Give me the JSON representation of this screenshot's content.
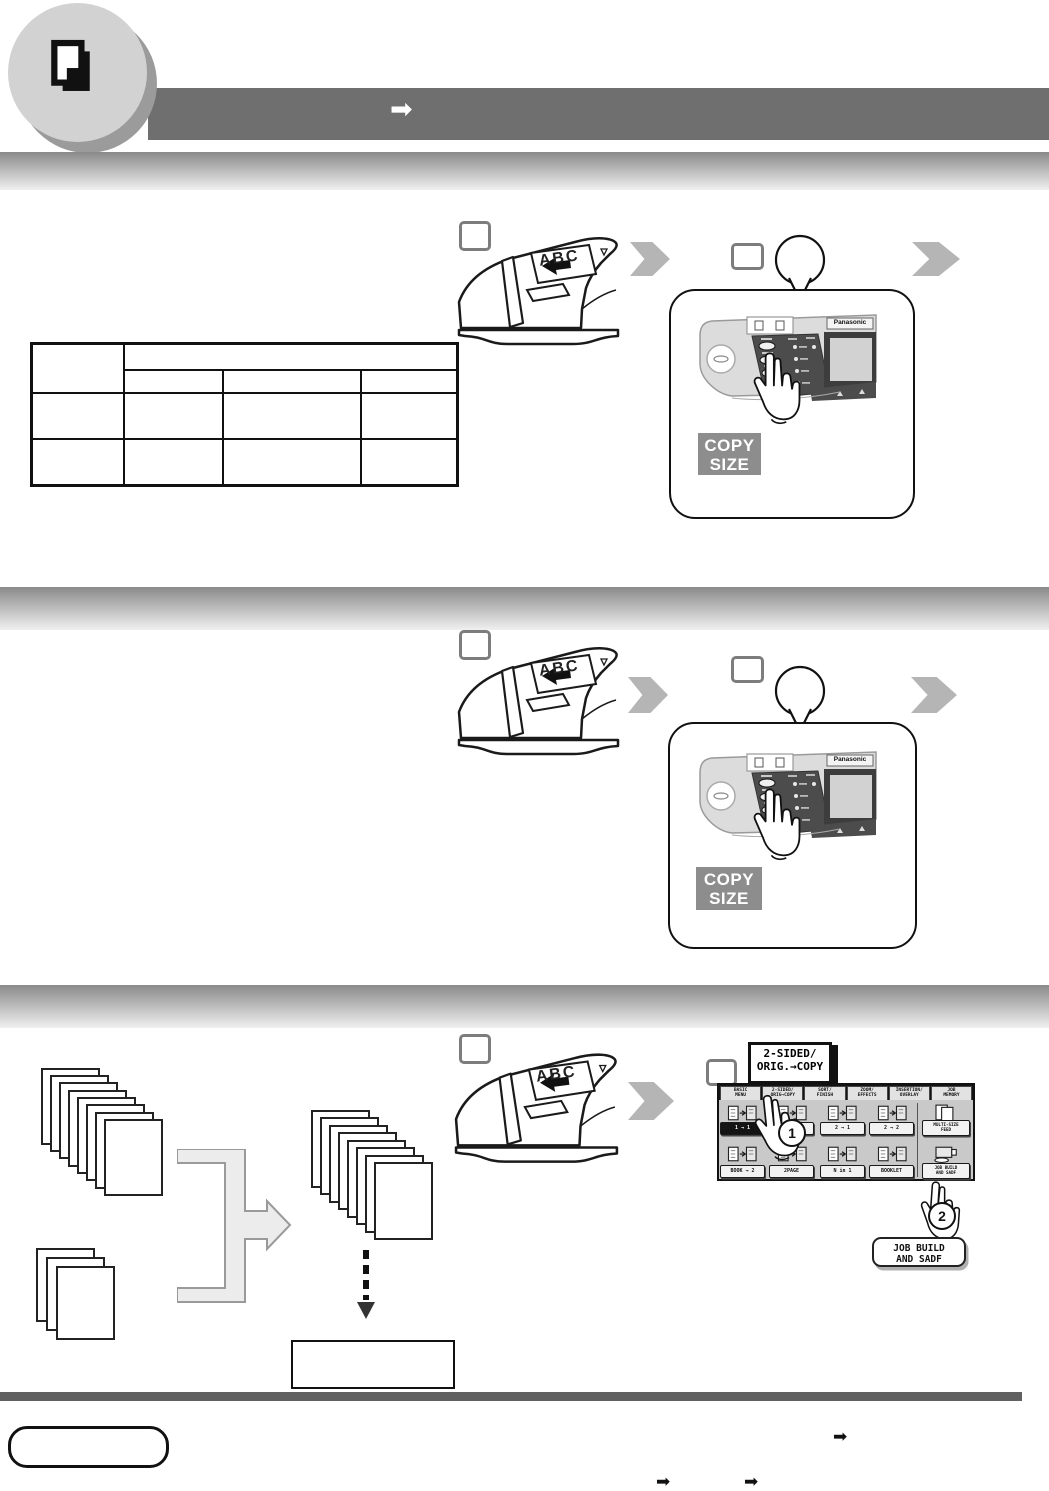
{
  "header": {
    "doc_icon": "copy-document-icon",
    "arrow_glyph": "➡"
  },
  "brand": {
    "logo": "Panasonic"
  },
  "scanner": {
    "abc_label": "ABC"
  },
  "copy_size": {
    "line1": "COPY",
    "line2": "SIZE"
  },
  "steps": {
    "one": "1",
    "two": "2"
  },
  "touchscreen": {
    "callout": {
      "line1": "2-SIDED/",
      "line2": "ORIG.→COPY"
    },
    "tabs": [
      {
        "l1": "BASIC",
        "l2": "MENU"
      },
      {
        "l1": "2-SIDED/",
        "l2": "ORIG→COPY"
      },
      {
        "l1": "SORT/",
        "l2": "FINISH"
      },
      {
        "l1": "ZOOM/",
        "l2": "EFFECTS"
      },
      {
        "l1": "INSERTION/",
        "l2": "OVERLAY"
      },
      {
        "l1": "JOB",
        "l2": "MEMORY"
      }
    ],
    "row1": [
      {
        "label": "1 → 1"
      },
      {
        "label": ""
      },
      {
        "label": "2 → 1"
      },
      {
        "label": "2 → 2"
      },
      {
        "l1": "MULTI-SIZE",
        "l2": "FEED"
      }
    ],
    "row2": [
      {
        "label": "BOOK → 2"
      },
      {
        "label": "2PAGE"
      },
      {
        "label": "N in 1"
      },
      {
        "label": "BOOKLET"
      },
      {
        "l1": "JOB BUILD",
        "l2": "AND SADF"
      }
    ],
    "job_build_callout": {
      "line1": "JOB BUILD",
      "line2": "AND SADF"
    }
  },
  "footer": {
    "arrow_glyph": "➡"
  }
}
